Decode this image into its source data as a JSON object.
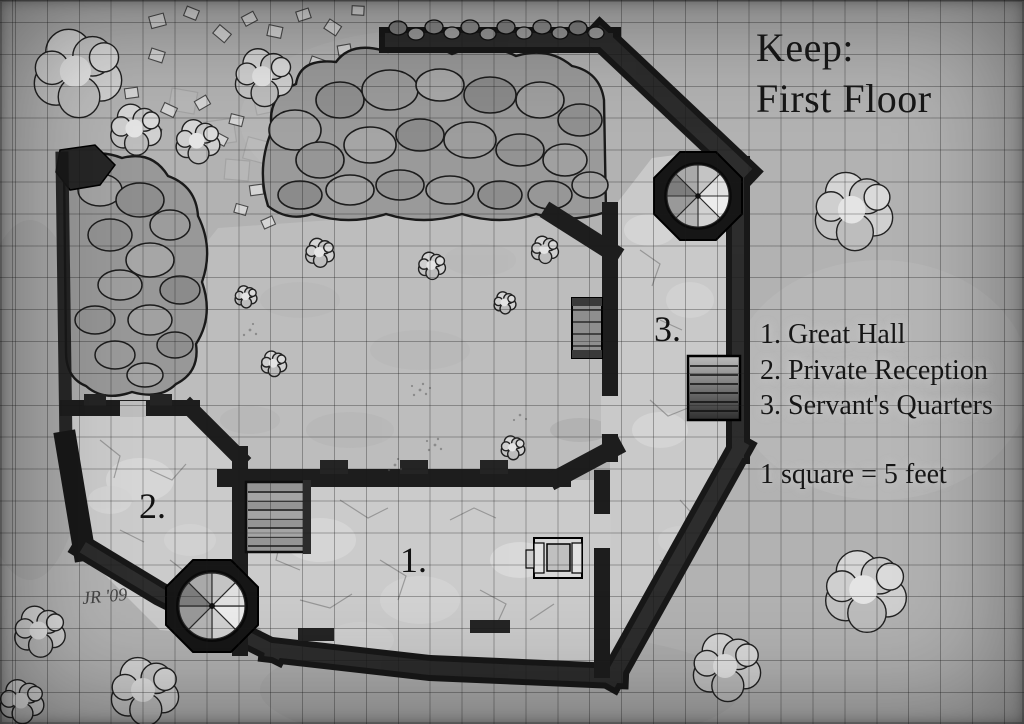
{
  "title": {
    "line1": "Keep:",
    "line2": "First Floor"
  },
  "legend": {
    "items": [
      "1. Great Hall",
      "2. Private Reception",
      "3. Servant's Quarters"
    ]
  },
  "scale": {
    "text": "1 square = 5 feet"
  },
  "rooms": [
    {
      "marker": "1.",
      "name": "Great Hall"
    },
    {
      "marker": "2.",
      "name": "Private Reception"
    },
    {
      "marker": "3.",
      "name": "Servant's Quarters"
    }
  ],
  "signature": {
    "text": "JR '09"
  },
  "colors": {
    "ground": "#b2b2b2",
    "courtyard_floor": "#bdbdbd",
    "room_floor": "#cbcbcb",
    "wall": "#181818",
    "ink": "#161616",
    "grid_line": "rgba(25,25,25,0.33)"
  }
}
